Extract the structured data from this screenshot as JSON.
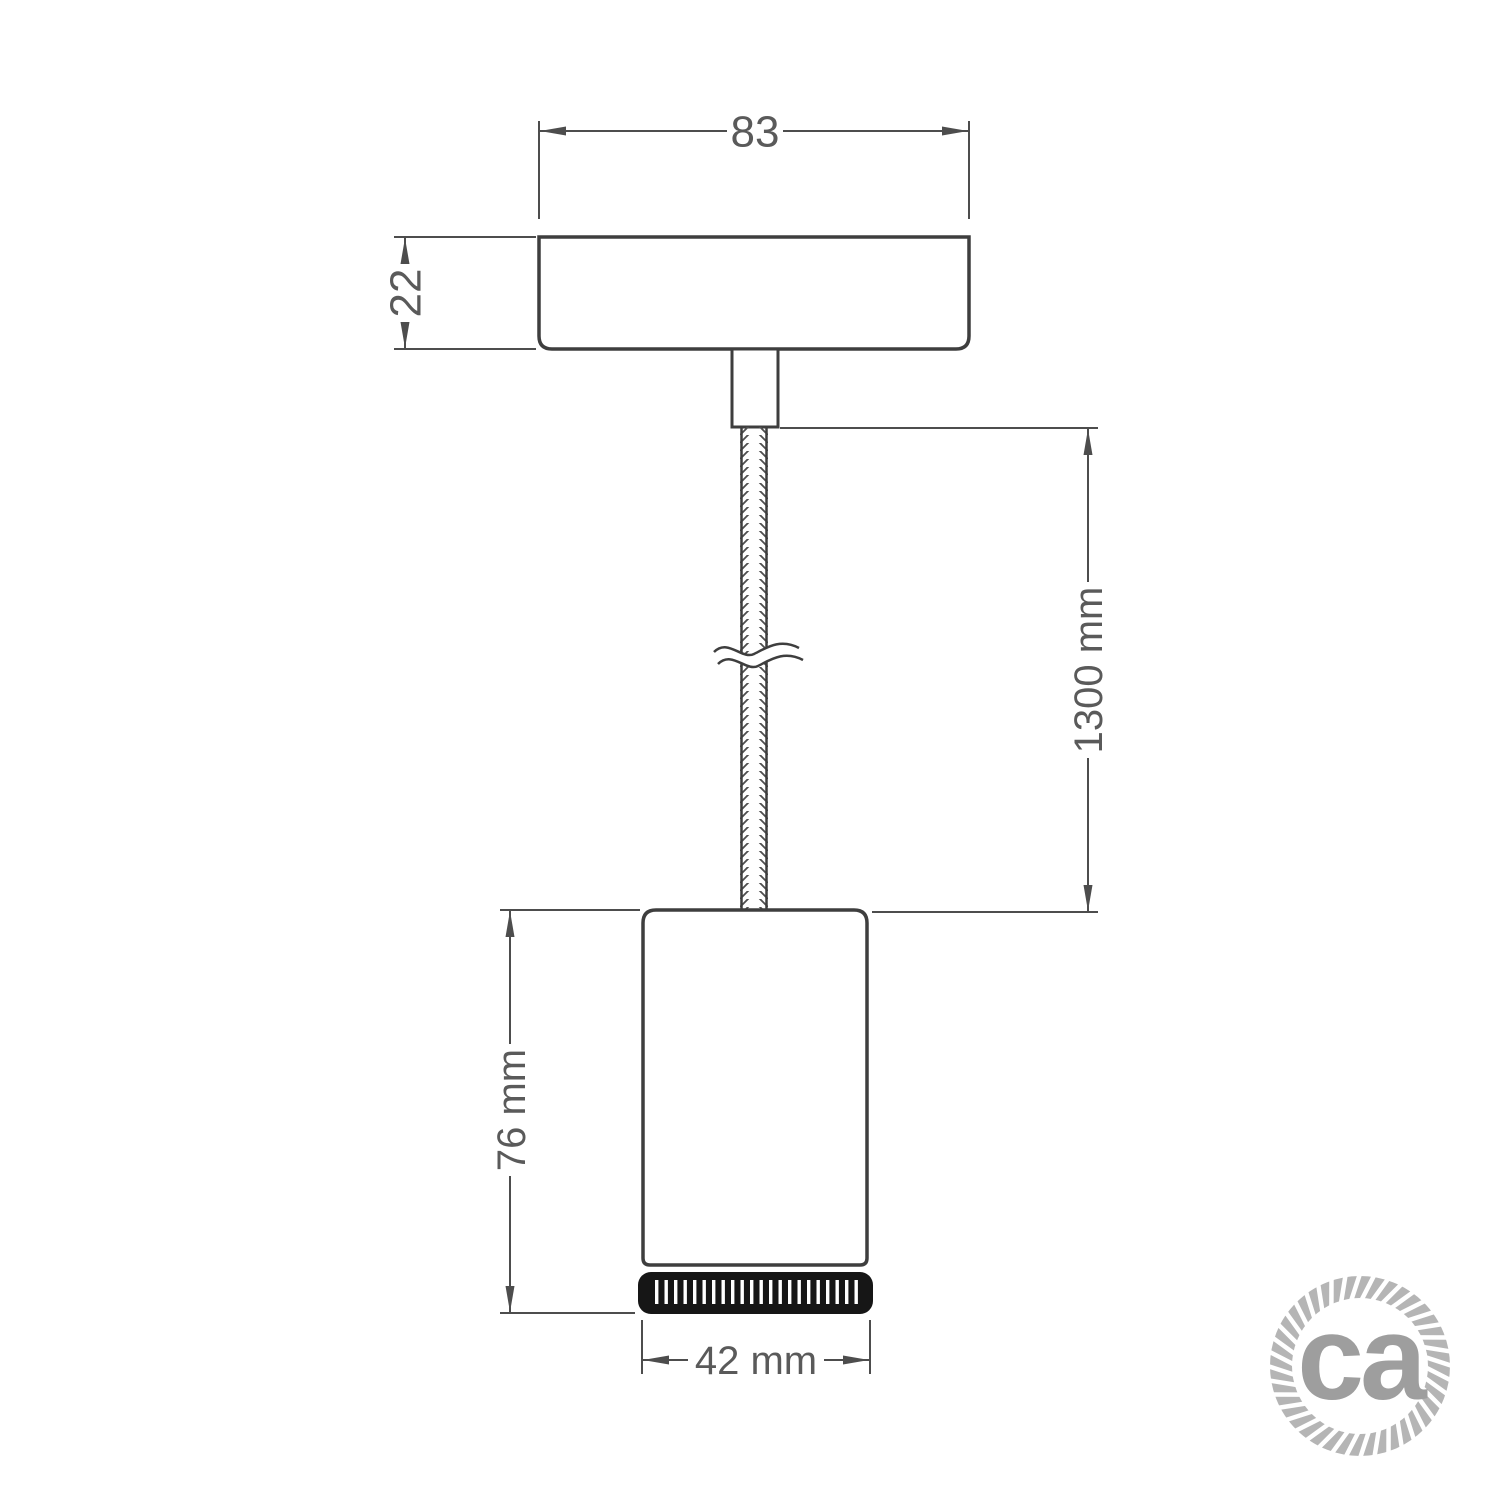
{
  "dimensions": {
    "canopy_width": "83",
    "canopy_height": "22",
    "cable_length": "1300 mm",
    "spotlight_height": "76 mm",
    "spotlight_width": "42 mm"
  },
  "logo": {
    "text": "ca"
  },
  "colors": {
    "background": "#ffffff",
    "line": "#3e3e3e",
    "dimension": "#4d4d4d",
    "label_text": "#5a5a5a",
    "cable_weave": "#4f4f4f",
    "ring_black": "#161616",
    "logo_gray": "#b5b5b5",
    "logo_text_gray": "#9e9e9e"
  }
}
